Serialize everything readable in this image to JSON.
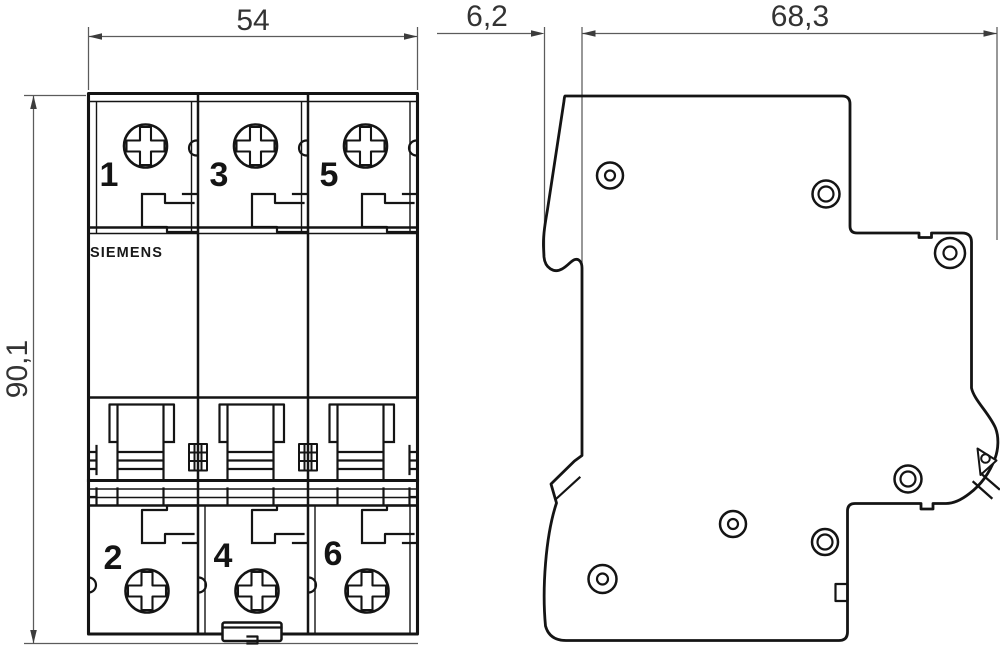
{
  "drawing": {
    "brand": "SIEMENS",
    "dimensions": {
      "front_width": "54",
      "front_height": "90,1",
      "side_front_depth": "6,2",
      "side_body_depth": "68,3"
    },
    "front_view": {
      "terminals_top": [
        "1",
        "3",
        "5"
      ],
      "terminals_bottom": [
        "2",
        "4",
        "6"
      ]
    },
    "colors": {
      "line": "#141414",
      "dimension_line": "#5b5b5b",
      "dimension_text": "#333333",
      "background": "#ffffff"
    }
  }
}
